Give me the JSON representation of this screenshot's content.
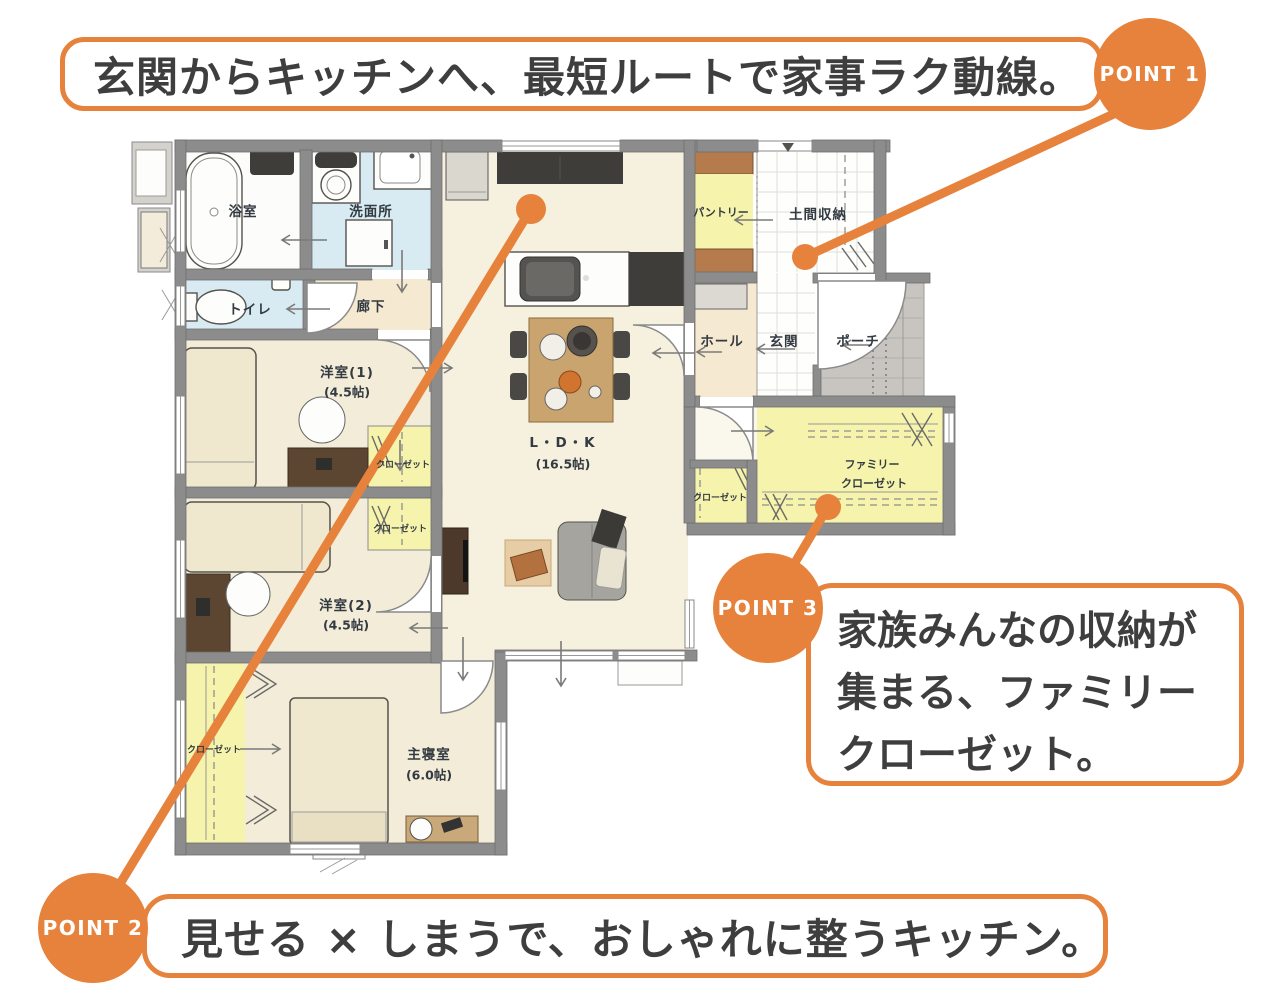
{
  "callouts": {
    "point1": {
      "badge": "POINT 1",
      "text": "玄関からキッチンへ、最短ルートで家事ラク動線。"
    },
    "point2": {
      "badge": "POINT 2",
      "text": "見せる × しまうで、おしゃれに整うキッチン。"
    },
    "point3": {
      "badge": "POINT 3",
      "line1": "家族みんなの収納が",
      "line2": "集まる、ファミリー",
      "line3": "クローゼット。"
    }
  },
  "rooms": {
    "bath": "浴室",
    "washroom": "洗面所",
    "toilet": "トイレ",
    "hallway": "廊下",
    "western1": "洋室(1)",
    "western1_size": "(4.5帖)",
    "western2": "洋室(2)",
    "western2_size": "(4.5帖)",
    "master": "主寝室",
    "master_size": "(6.0帖)",
    "ldk": "L・D・K",
    "ldk_size": "(16.5帖)",
    "pantry": "パントリー",
    "doma_storage": "土間収納",
    "hall": "ホール",
    "entrance": "玄関",
    "porch": "ポーチ",
    "family_closet_line1": "ファミリー",
    "family_closet_line2": "クローゼット",
    "closet_hall": "クローゼット",
    "closet_western1": "クローゼット",
    "closet_western2": "クローゼット",
    "closet_master": "クローゼット"
  },
  "colors": {
    "accent": "#E6823B",
    "wall": "#8C8C8C",
    "floor_cream": "#F6F0DE",
    "floor_warm": "#F2ECD8",
    "floor_beige": "#F6E9D1",
    "water_blue": "#D8EAF2",
    "closet_yellow": "#F5F3AC",
    "wood_brown": "#B57B4C",
    "porch_gray": "#C8C5C1",
    "ink": "#3E3E3E",
    "label_ink": "#333A42"
  }
}
